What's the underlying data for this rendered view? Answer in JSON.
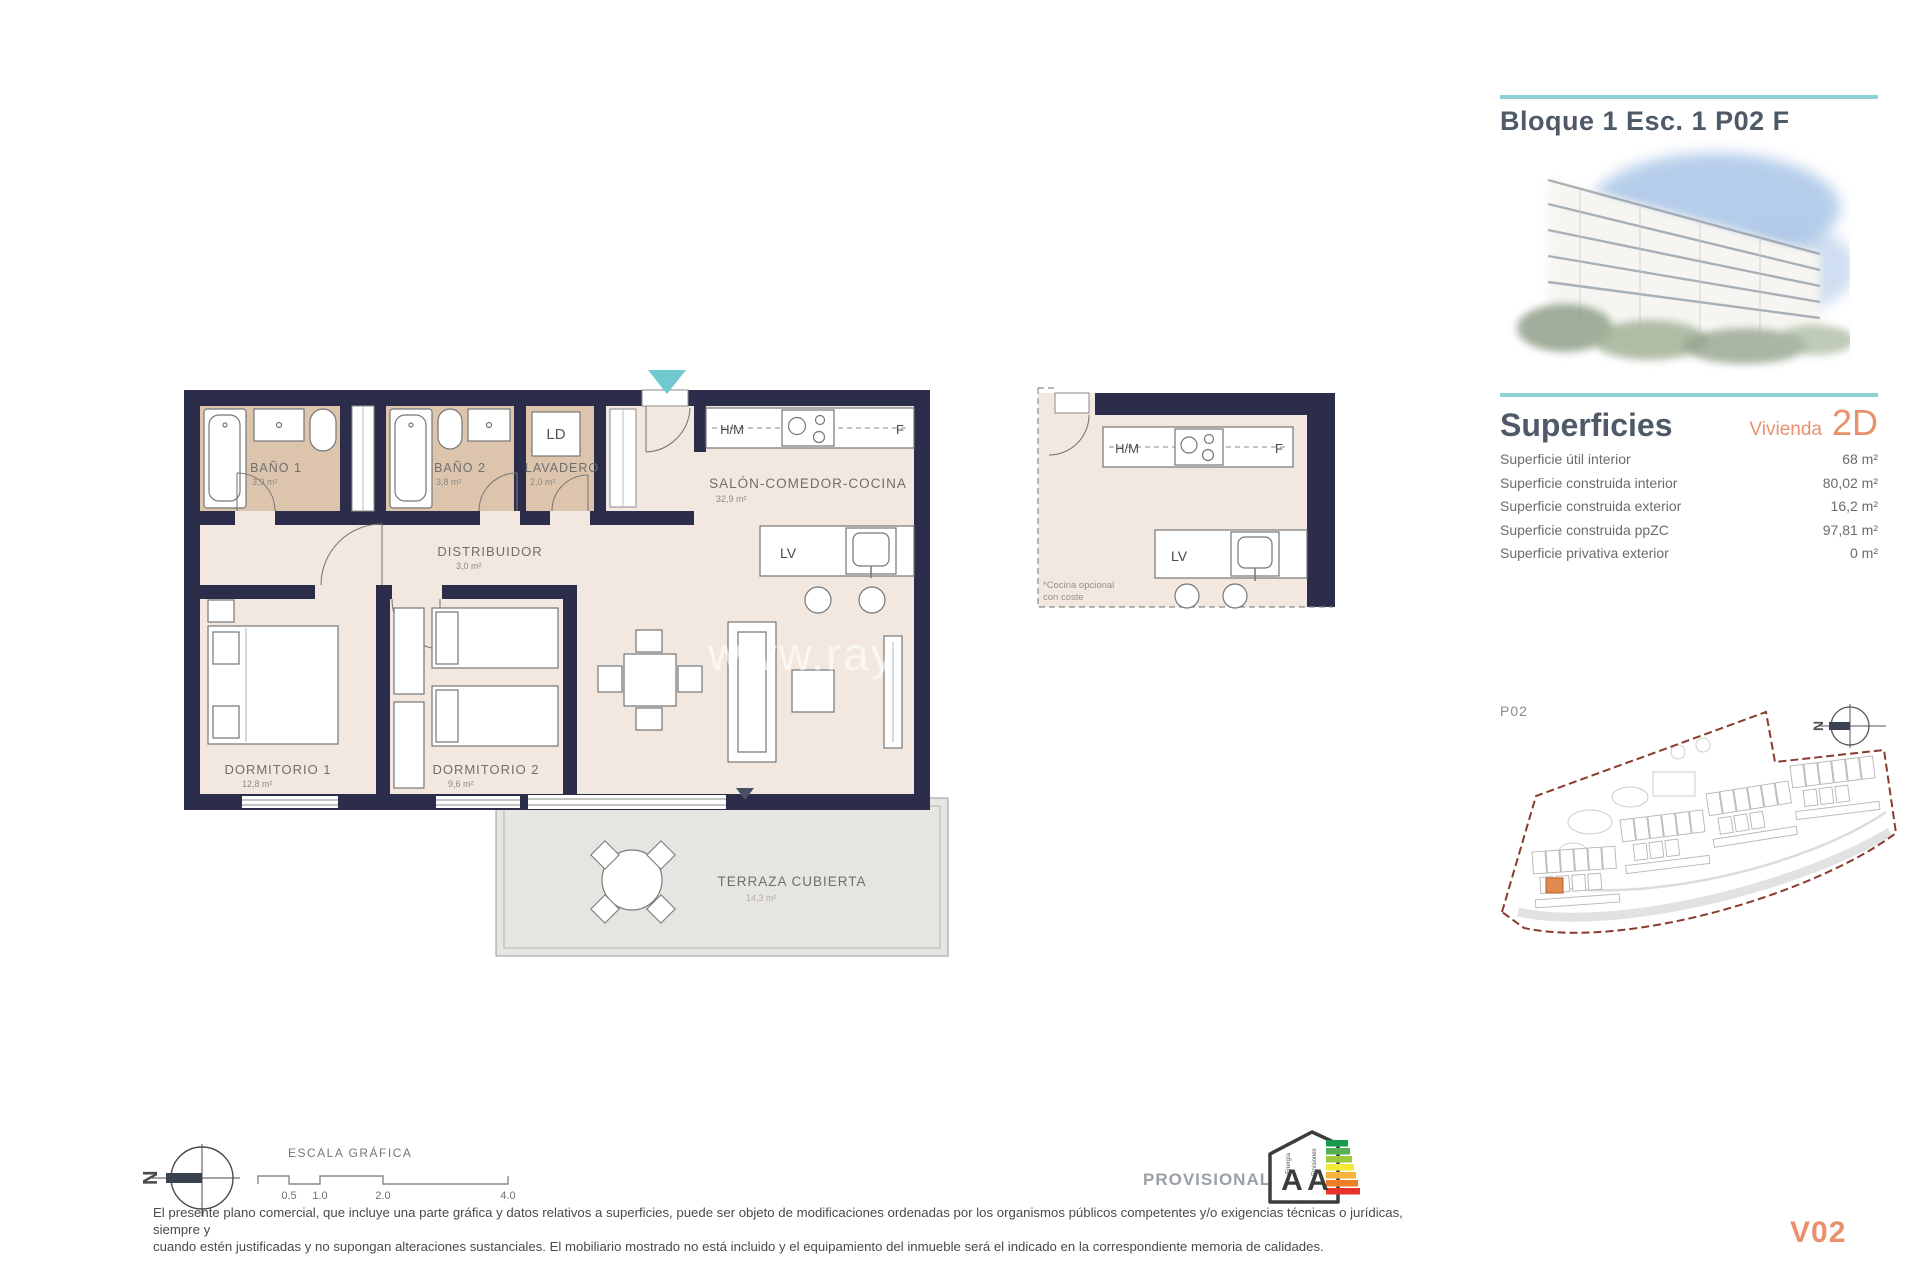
{
  "header": {
    "title": "Bloque 1 Esc. 1 P02 F",
    "accent_teal": "#8ed2d6",
    "text_color": "#4e5a68"
  },
  "superficies": {
    "heading": "Superficies",
    "vivienda_label": "Vivienda",
    "tipo_label": "2D",
    "accent_orange": "#e9916c",
    "rows": [
      {
        "label": "Superficie útil interior",
        "value": "68 m²"
      },
      {
        "label": "Superficie construida interior",
        "value": "80,02 m²"
      },
      {
        "label": "Superficie construida exterior",
        "value": "16,2 m²"
      },
      {
        "label": "Superficie construida ppZC",
        "value": "97,81 m²"
      },
      {
        "label": "Superficie privativa exterior",
        "value": "0 m²"
      }
    ]
  },
  "floorplan": {
    "wall_color": "#2b2d4a",
    "wet_room_color": "#dcc5ac",
    "floor_color": "#f2e8e0",
    "terrace_color": "#e7e5e2",
    "entrance_arrow_color": "#6fc9cf",
    "rooms": {
      "bano1": {
        "name": "BAÑO 1",
        "area": "3,9 m²"
      },
      "bano2": {
        "name": "BAÑO 2",
        "area": "3,8 m²"
      },
      "lavadero": {
        "name": "LAVADERO",
        "area": "2,0 m²"
      },
      "distribuidor": {
        "name": "DISTRIBUIDOR",
        "area": "3,0 m²"
      },
      "salon": {
        "name": "SALÓN-COMEDOR-COCINA",
        "area": "32,9 m²"
      },
      "dormitorio1": {
        "name": "DORMITORIO 1",
        "area": "12,8 m²"
      },
      "dormitorio2": {
        "name": "DORMITORIO 2",
        "area": "9,6 m²"
      },
      "terraza": {
        "name": "TERRAZA CUBIERTA",
        "area": "14,3 m²"
      }
    },
    "fixtures": {
      "ld": "LD",
      "hm": "H/M",
      "f": "F",
      "lv": "LV"
    },
    "watermark": "www.ray"
  },
  "kitchen_detail": {
    "hm": "H/M",
    "f": "F",
    "lv": "LV",
    "note_line1": "*Cocina opcional",
    "note_line2": "con coste"
  },
  "siteplan": {
    "label": "P02",
    "north_letter": "N",
    "boundary_color": "#8a3c2c",
    "highlight_color": "#e08a52"
  },
  "scalebar": {
    "title": "ESCALA GRÁFICA",
    "ticks": [
      "0.5",
      "1.0",
      "2.0",
      "4.0"
    ]
  },
  "north_compass": {
    "letter": "N"
  },
  "energy_badge": {
    "status_label": "PROVISIONAL",
    "letter_energy": "A",
    "letter_emissions": "A",
    "word_energy": "Energía",
    "word_emissions": "Emisiones"
  },
  "footer": {
    "disclaimer_line1": "El presente plano comercial, que incluye una parte gráfica y datos relativos a superficies, puede ser objeto de modificaciones ordenadas por los organismos públicos competentes y/o exigencias técnicas o jurídicas, siempre y",
    "disclaimer_line2": "cuando estén justificadas y no supongan alteraciones sustanciales. El mobiliario mostrado no está incluido y el equipamiento del inmueble será el indicado en la correspondiente memoria de calidades.",
    "version": "V02"
  }
}
